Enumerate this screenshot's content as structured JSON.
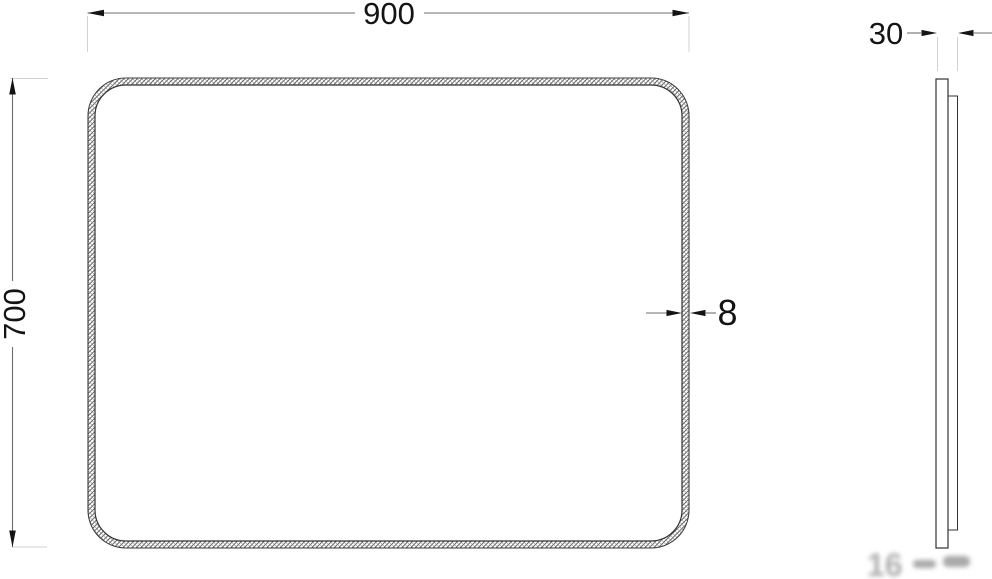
{
  "colors": {
    "background": "#ffffff",
    "object_line": "#333333",
    "dimension_line": "#6e6e6e",
    "arrowhead": "#141414",
    "extension_line": "#d2d2d2",
    "hatch_line": "#555555",
    "dimension_text": "#141414",
    "watermark": "#777777"
  },
  "front_view": {
    "width_label": "900",
    "height_label": "700",
    "frame_thickness_label": "8"
  },
  "side_view": {
    "depth_label": "30"
  },
  "watermark": {
    "text": "16"
  }
}
